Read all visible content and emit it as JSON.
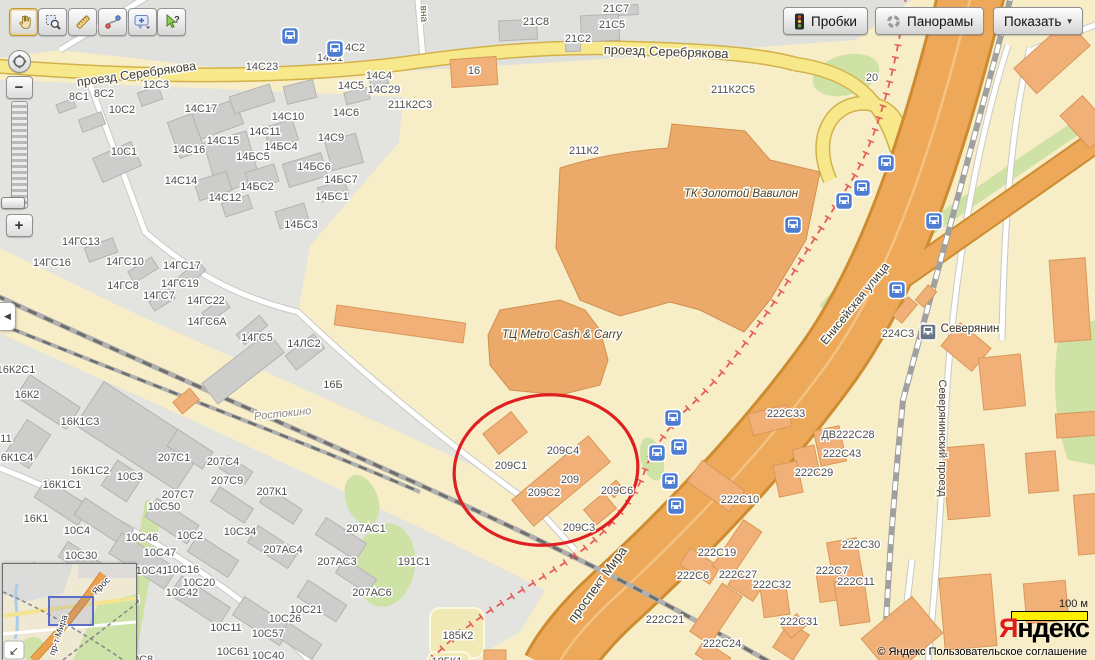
{
  "toolbar": {
    "tools": [
      {
        "name": "pan-tool",
        "active": true
      },
      {
        "name": "zoom-select-tool",
        "active": false
      },
      {
        "name": "ruler-tool",
        "active": false
      },
      {
        "name": "route-tool",
        "active": false
      },
      {
        "name": "add-placemark-tool",
        "active": false
      },
      {
        "name": "inspect-tool",
        "active": false,
        "badge": "?"
      }
    ]
  },
  "header_buttons": {
    "traffic": "Пробки",
    "panoramas": "Панорамы",
    "show": "Показать",
    "show_caret": "▾"
  },
  "zoom_control": {
    "minus": "−",
    "plus": "+",
    "collapse_arrow": "◀"
  },
  "map": {
    "colors": {
      "annotation_red": "#e02020",
      "boundary_red": "#e34f4f",
      "bus_icon_blue": "#4d7dd2",
      "highway_orange": "#eda85a",
      "road_yellow": "#f8e88c",
      "building_orange": "#f1b078",
      "building_gray": "#cdcdcb",
      "green_area": "#cfe2a6"
    },
    "street_labels": [
      {
        "text": "проезд Серебрякова",
        "x": 137,
        "y": 78,
        "rot": -8,
        "size": 12.5,
        "color": "#3e3e3e"
      },
      {
        "text": "проезд Серебрякова",
        "x": 666,
        "y": 56,
        "rot": 2,
        "size": 13,
        "color": "#3e3e3e"
      },
      {
        "text": "Енисейская улица",
        "x": 858,
        "y": 306,
        "rot": -51,
        "size": 12,
        "color": "#3e3e3e"
      },
      {
        "text": "проспект Мира",
        "x": 601,
        "y": 587,
        "rot": -54,
        "size": 13,
        "color": "#3e3e3e"
      },
      {
        "text": "Северянинский проезд",
        "x": 939,
        "y": 438,
        "rot": 90,
        "size": 11,
        "color": "#3e3e3e"
      },
      {
        "text": "Ростокино",
        "x": 283,
        "y": 417,
        "rot": -6,
        "size": 11,
        "color": "#8a8a8a",
        "italic": true
      },
      {
        "text": "ТК Золотой Вавилон",
        "x": 741,
        "y": 197,
        "rot": 0,
        "size": 11.5,
        "color": "#4a4231",
        "italic": true
      },
      {
        "text": "ТЦ Metro Cash & Carry",
        "x": 562,
        "y": 338,
        "rot": 0,
        "size": 11.5,
        "color": "#4a4231",
        "italic": true
      },
      {
        "text": "Северянин",
        "x": 970,
        "y": 332,
        "rot": 0,
        "size": 11.5,
        "color": "#2e2e2e"
      },
      {
        "text": "вна",
        "x": 421,
        "y": 14,
        "rot": 87,
        "size": 10,
        "color": "#555555"
      }
    ],
    "building_labels": [
      [
        "14С2",
        352,
        47
      ],
      [
        "14С1",
        330,
        57
      ],
      [
        "14С23",
        262,
        66
      ],
      [
        "12С3",
        156,
        84
      ],
      [
        "8С1",
        79,
        96
      ],
      [
        "8С2",
        104,
        93
      ],
      [
        "10С2",
        122,
        109
      ],
      [
        "14С17",
        201,
        108
      ],
      [
        "14С4",
        379,
        75
      ],
      [
        "14С5",
        351,
        85
      ],
      [
        "14С29",
        384,
        89
      ],
      [
        "14С6",
        346,
        112
      ],
      [
        "14С10",
        288,
        116
      ],
      [
        "14С11",
        265,
        131
      ],
      [
        "14С9",
        331,
        137
      ],
      [
        "14С15",
        223,
        140
      ],
      [
        "14БС4",
        281,
        146
      ],
      [
        "14БС5",
        253,
        156
      ],
      [
        "14С16",
        189,
        149
      ],
      [
        "10С1",
        124,
        151
      ],
      [
        "14БС6",
        314,
        166
      ],
      [
        "14БС7",
        341,
        179
      ],
      [
        "14С14",
        181,
        180
      ],
      [
        "14БС2",
        257,
        186
      ],
      [
        "14С12",
        225,
        197
      ],
      [
        "14БС1",
        332,
        196
      ],
      [
        "14БС3",
        301,
        224
      ],
      [
        "14ГС13",
        81,
        241
      ],
      [
        "14ГС16",
        52,
        262
      ],
      [
        "14ГС10",
        125,
        261
      ],
      [
        "14ГС17",
        182,
        265
      ],
      [
        "14ГС8",
        123,
        285
      ],
      [
        "14ГС19",
        180,
        283
      ],
      [
        "14ГС7",
        159,
        295
      ],
      [
        "14ГС22",
        206,
        300
      ],
      [
        "14ГС6А",
        207,
        321
      ],
      [
        "14ГС5",
        257,
        337
      ],
      [
        "14ЛС2",
        304,
        343
      ],
      [
        "16Б",
        333,
        384
      ],
      [
        "21С8",
        536,
        21
      ],
      [
        "21С7",
        616,
        8
      ],
      [
        "21С5",
        612,
        24
      ],
      [
        "21С2",
        578,
        38
      ],
      [
        "16",
        474,
        70
      ],
      [
        "211К2С3",
        410,
        104
      ],
      [
        "211К2С5",
        733,
        89
      ],
      [
        "211К2",
        584,
        150
      ],
      [
        "20",
        872,
        77
      ],
      [
        "16К2С1",
        16,
        369
      ],
      [
        "16К2",
        27,
        394
      ],
      [
        "16К1С3",
        80,
        421
      ],
      [
        "11",
        6,
        438
      ],
      [
        "16К1С4",
        14,
        457
      ],
      [
        "16К1С2",
        90,
        470
      ],
      [
        "16К1С1",
        62,
        484
      ],
      [
        "16К1",
        36,
        518
      ],
      [
        "207С1",
        174,
        457
      ],
      [
        "207С4",
        223,
        461
      ],
      [
        "207С9",
        227,
        480
      ],
      [
        "207К1",
        272,
        491
      ],
      [
        "207С7",
        178,
        494
      ],
      [
        "10С3",
        130,
        476
      ],
      [
        "10С50",
        164,
        506
      ],
      [
        "10С4",
        77,
        530
      ],
      [
        "10С30",
        81,
        555
      ],
      [
        "10С46",
        142,
        537
      ],
      [
        "10С2",
        190,
        535
      ],
      [
        "10С34",
        240,
        531
      ],
      [
        "10С47",
        160,
        552
      ],
      [
        "207АС4",
        283,
        549
      ],
      [
        "207АС1",
        366,
        528
      ],
      [
        "207АС3",
        337,
        561
      ],
      [
        "191С1",
        414,
        561
      ],
      [
        "10С41",
        152,
        570
      ],
      [
        "10С16",
        183,
        569
      ],
      [
        "10С20",
        199,
        582
      ],
      [
        "10С42",
        182,
        592
      ],
      [
        "207АС6",
        372,
        592
      ],
      [
        "10С21",
        306,
        609
      ],
      [
        "10С26",
        285,
        618
      ],
      [
        "10С11",
        226,
        627
      ],
      [
        "10С57",
        268,
        633
      ],
      [
        "10С61",
        233,
        651
      ],
      [
        "10С40",
        268,
        655
      ],
      [
        "5",
        136,
        600
      ],
      [
        "10С8",
        140,
        659
      ],
      [
        "185К2",
        458,
        635
      ],
      [
        "185К1",
        447,
        661
      ],
      [
        "209С4",
        563,
        450
      ],
      [
        "209С1",
        511,
        465
      ],
      [
        "209",
        570,
        479
      ],
      [
        "209С2",
        544,
        492
      ],
      [
        "209С6",
        617,
        490
      ],
      [
        "209С3",
        579,
        527
      ],
      [
        "224С3",
        898,
        333
      ],
      [
        "222С33",
        786,
        413
      ],
      [
        "ДВ222С28",
        848,
        434
      ],
      [
        "222С43",
        842,
        453
      ],
      [
        "222С29",
        814,
        472
      ],
      [
        "222С10",
        740,
        499
      ],
      [
        "222С30",
        861,
        544
      ],
      [
        "222С19",
        717,
        552
      ],
      [
        "222С6",
        693,
        575
      ],
      [
        "222С27",
        738,
        574
      ],
      [
        "222С32",
        772,
        584
      ],
      [
        "222С7",
        832,
        570
      ],
      [
        "222С11",
        856,
        581
      ],
      [
        "222С31",
        799,
        621
      ],
      [
        "222С24",
        722,
        643
      ],
      [
        "222С21",
        665,
        619
      ]
    ],
    "bus_stops": [
      [
        290,
        36
      ],
      [
        335,
        49
      ],
      [
        886,
        163
      ],
      [
        862,
        188
      ],
      [
        844,
        201
      ],
      [
        934,
        221
      ],
      [
        793,
        225
      ],
      [
        897,
        290
      ],
      [
        673,
        418
      ],
      [
        679,
        447
      ],
      [
        657,
        453
      ],
      [
        670,
        481
      ],
      [
        676,
        506
      ]
    ],
    "station": {
      "x": 928,
      "y": 332
    },
    "red_circle": {
      "cx": 546,
      "cy": 470,
      "rx": 92,
      "ry": 75
    }
  },
  "minimap": {
    "labels": [
      {
        "text": "Ярос",
        "x": 100,
        "y": 24,
        "rot": -45,
        "size": 9
      },
      {
        "text": "пр-т Мира",
        "x": 58,
        "y": 72,
        "rot": -72,
        "size": 9
      }
    ],
    "collapse_arrow": "↙"
  },
  "scale_bar": {
    "label": "100 м"
  },
  "logo": {
    "lead": "Я",
    "rest": "ндекс"
  },
  "copyright": {
    "prefix": "© Яндекс",
    "link_label": "Пользовательское соглашение"
  }
}
